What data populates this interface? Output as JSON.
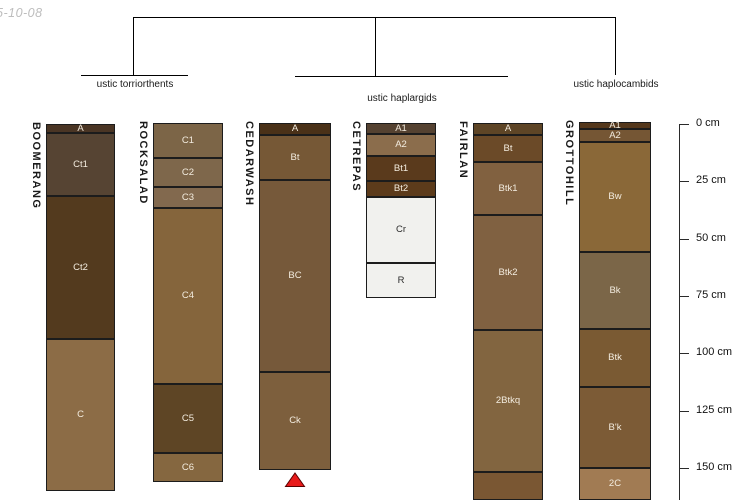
{
  "meta": {
    "date_note": "5-10-08"
  },
  "tree": {
    "groups": [
      {
        "label": "ustic torriorthents"
      },
      {
        "label": "ustic haplargids"
      },
      {
        "label": "ustic haplocambids"
      }
    ]
  },
  "ruler": {
    "unit": "cm",
    "tick_labels": [
      "0 cm",
      "25 cm",
      "50 cm",
      "75 cm",
      "100 cm",
      "125 cm",
      "150 cm"
    ]
  },
  "marker_color": "#e81a1a",
  "profiles": [
    {
      "name": "BOOMERANG",
      "group": "ustic torriorthents",
      "x": 46,
      "width": 69,
      "horizons": [
        {
          "label": "A",
          "top": 124,
          "bottom": 133,
          "depth_cm": [
            0,
            4
          ],
          "color": "#4a3524"
        },
        {
          "label": "Ct1",
          "top": 133,
          "bottom": 196,
          "depth_cm": [
            4,
            31
          ],
          "color": "#564433"
        },
        {
          "label": "Ct2",
          "top": 196,
          "bottom": 339,
          "depth_cm": [
            31,
            94
          ],
          "color": "#533a1e"
        },
        {
          "label": "C",
          "top": 339,
          "bottom": 491,
          "depth_cm": [
            94,
            160
          ],
          "color": "#8c6c46"
        }
      ]
    },
    {
      "name": "ROCKSALAD",
      "group": "ustic torriorthents",
      "x": 153,
      "width": 70,
      "horizons": [
        {
          "label": "C1",
          "top": 123,
          "bottom": 158,
          "depth_cm": [
            0,
            15
          ],
          "color": "#7c6547"
        },
        {
          "label": "C2",
          "top": 158,
          "bottom": 187,
          "depth_cm": [
            15,
            27
          ],
          "color": "#7e674b"
        },
        {
          "label": "C3",
          "top": 187,
          "bottom": 208,
          "depth_cm": [
            27,
            37
          ],
          "color": "#82694e"
        },
        {
          "label": "C4",
          "top": 208,
          "bottom": 384,
          "depth_cm": [
            37,
            113
          ],
          "color": "#85653c"
        },
        {
          "label": "C5",
          "top": 384,
          "bottom": 453,
          "depth_cm": [
            113,
            143
          ],
          "color": "#5e4525"
        },
        {
          "label": "C6",
          "top": 453,
          "bottom": 482,
          "depth_cm": [
            143,
            156
          ],
          "color": "#856740"
        }
      ]
    },
    {
      "name": "CEDARWASH",
      "group": "ustic haplargids",
      "x": 259,
      "width": 72,
      "marker": "red-triangle",
      "horizons": [
        {
          "label": "A",
          "top": 123,
          "bottom": 135,
          "depth_cm": [
            0,
            5
          ],
          "color": "#4a3118"
        },
        {
          "label": "Bt",
          "top": 135,
          "bottom": 180,
          "depth_cm": [
            5,
            24
          ],
          "color": "#765836"
        },
        {
          "label": "BC",
          "top": 180,
          "bottom": 372,
          "depth_cm": [
            24,
            108
          ],
          "color": "#76593a"
        },
        {
          "label": "Ck",
          "top": 372,
          "bottom": 470,
          "depth_cm": [
            108,
            151
          ],
          "color": "#7d5f3d"
        }
      ]
    },
    {
      "name": "CETREPAS",
      "group": "ustic haplargids",
      "x": 366,
      "width": 70,
      "horizons": [
        {
          "label": "A1",
          "top": 123,
          "bottom": 134,
          "depth_cm": [
            0,
            4
          ],
          "color": "#554231"
        },
        {
          "label": "A2",
          "top": 134,
          "bottom": 156,
          "depth_cm": [
            4,
            14
          ],
          "color": "#8b6d4c"
        },
        {
          "label": "Bt1",
          "top": 156,
          "bottom": 181,
          "depth_cm": [
            14,
            25
          ],
          "color": "#5a3a1c"
        },
        {
          "label": "Bt2",
          "top": 181,
          "bottom": 197,
          "depth_cm": [
            25,
            32
          ],
          "color": "#5c3b1b"
        },
        {
          "label": "Cr",
          "top": 197,
          "bottom": 263,
          "depth_cm": [
            32,
            61
          ],
          "color": "#f1f1ee"
        },
        {
          "label": "R",
          "top": 263,
          "bottom": 298,
          "depth_cm": [
            61,
            76
          ],
          "color": "#f1f1ee"
        }
      ]
    },
    {
      "name": "FAIRLAN",
      "group": "ustic haplargids",
      "x": 473,
      "width": 70,
      "horizons": [
        {
          "label": "A",
          "top": 123,
          "bottom": 135,
          "depth_cm": [
            0,
            5
          ],
          "color": "#5e4526"
        },
        {
          "label": "Bt",
          "top": 135,
          "bottom": 162,
          "depth_cm": [
            5,
            17
          ],
          "color": "#6b4a28"
        },
        {
          "label": "Btk1",
          "top": 162,
          "bottom": 215,
          "depth_cm": [
            17,
            40
          ],
          "color": "#816140"
        },
        {
          "label": "Btk2",
          "top": 215,
          "bottom": 330,
          "depth_cm": [
            40,
            90
          ],
          "color": "#806141"
        },
        {
          "label": "2Btkq",
          "top": 330,
          "bottom": 472,
          "depth_cm": [
            90,
            152
          ],
          "color": "#826540"
        },
        {
          "label": "",
          "top": 472,
          "bottom": 500,
          "depth_cm": [
            152,
            164
          ],
          "color": "#7a5733"
        }
      ]
    },
    {
      "name": "GROTTOHILL",
      "group": "ustic haplocambids",
      "x": 579,
      "width": 72,
      "horizons": [
        {
          "label": "A1",
          "top": 122,
          "bottom": 129,
          "depth_cm": [
            0,
            2
          ],
          "color": "#55381c"
        },
        {
          "label": "A2",
          "top": 129,
          "bottom": 142,
          "depth_cm": [
            2,
            8
          ],
          "color": "#755634"
        },
        {
          "label": "Bw",
          "top": 142,
          "bottom": 252,
          "depth_cm": [
            8,
            56
          ],
          "color": "#8a6838"
        },
        {
          "label": "Bk",
          "top": 252,
          "bottom": 329,
          "depth_cm": [
            56,
            89
          ],
          "color": "#7b6648"
        },
        {
          "label": "Btk",
          "top": 329,
          "bottom": 387,
          "depth_cm": [
            89,
            115
          ],
          "color": "#7a5a33"
        },
        {
          "label": "B'k",
          "top": 387,
          "bottom": 468,
          "depth_cm": [
            115,
            150
          ],
          "color": "#7c5b36"
        },
        {
          "label": "2C",
          "top": 468,
          "bottom": 500,
          "depth_cm": [
            150,
            164
          ],
          "color": "#a17b53"
        }
      ]
    }
  ]
}
